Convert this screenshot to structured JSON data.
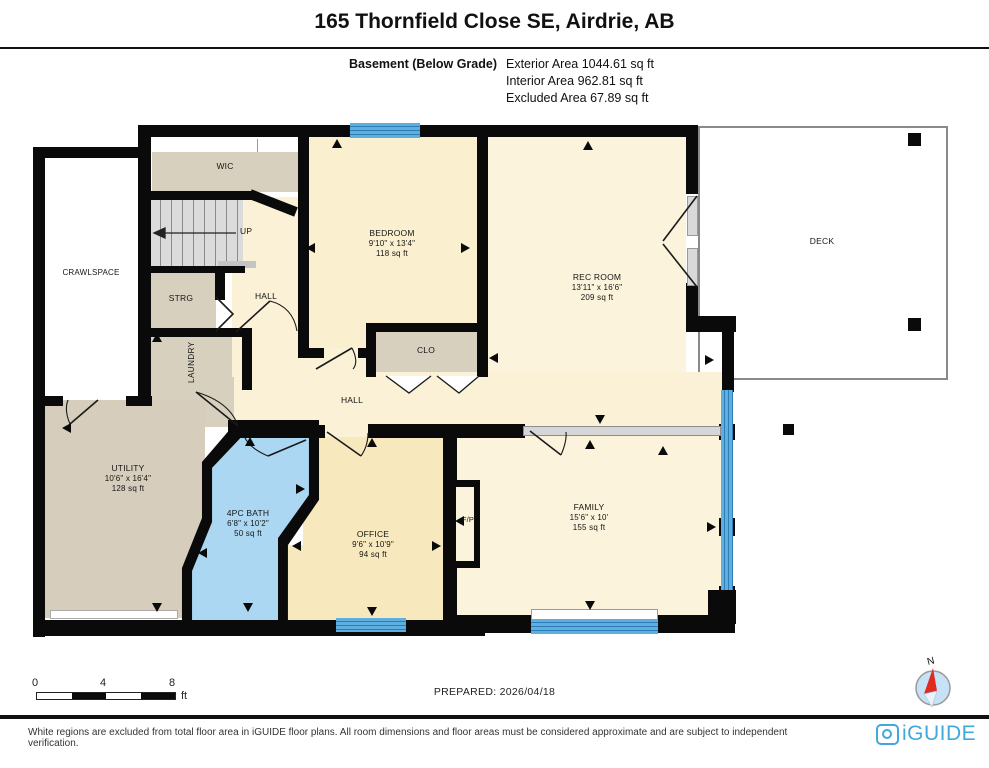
{
  "header": {
    "title": "165 Thornfield Close SE, Airdrie, AB",
    "floor_label": "Basement (Below Grade)",
    "area_lines": [
      "Exterior Area 1044.61 sq ft",
      "Interior Area 962.81 sq ft",
      "Excluded Area 67.89 sq ft"
    ]
  },
  "rooms": {
    "crawlspace": {
      "name": "CRAWLSPACE"
    },
    "wic": {
      "name": "WIC"
    },
    "stairs": {
      "name": "UP"
    },
    "strg": {
      "name": "STRG"
    },
    "hall_upper": {
      "name": "HALL"
    },
    "laundry": {
      "name": "LAUNDRY"
    },
    "bedroom": {
      "name": "BEDROOM",
      "dims": "9'10\" x 13'4\"",
      "area": "118 sq ft"
    },
    "clo": {
      "name": "CLO"
    },
    "rec_room": {
      "name": "REC ROOM",
      "dims": "13'11\" x 16'6\"",
      "area": "209 sq ft"
    },
    "deck": {
      "name": "DECK"
    },
    "hall": {
      "name": "HALL"
    },
    "utility": {
      "name": "UTILITY",
      "dims": "10'6\" x 16'4\"",
      "area": "128 sq ft"
    },
    "bath": {
      "name": "4PC BATH",
      "dims": "6'8\" x 10'2\"",
      "area": "50 sq ft"
    },
    "office": {
      "name": "OFFICE",
      "dims": "9'6\" x 10'9\"",
      "area": "94 sq ft"
    },
    "family": {
      "name": "FAMILY",
      "dims": "15'6\" x 10'",
      "area": "155 sq ft"
    },
    "fireplace": {
      "name": "F/P"
    }
  },
  "scale_bar": {
    "ticks": [
      "0",
      "4",
      "8"
    ],
    "unit": "ft"
  },
  "compass": {
    "north_label": "N"
  },
  "footer": {
    "prepared": "PREPARED: 2026/04/18",
    "disclaimer": "White regions are excluded from total floor area in iGUIDE floor plans. All room dimensions and floor areas must be considered approximate and are subject to independent verification.",
    "brand": "iGUIDE"
  },
  "colors": {
    "room_cream": "#FAF1D6",
    "room_cream_dark": "#F7E8BD",
    "room_tan": "#D8D0BF",
    "bath_blue": "#ABD7F2",
    "window_blue": "#4FA3D8",
    "wall_black": "#0A0A0A",
    "brand_blue": "#3FA9DC",
    "compass_red": "#E02B20"
  }
}
